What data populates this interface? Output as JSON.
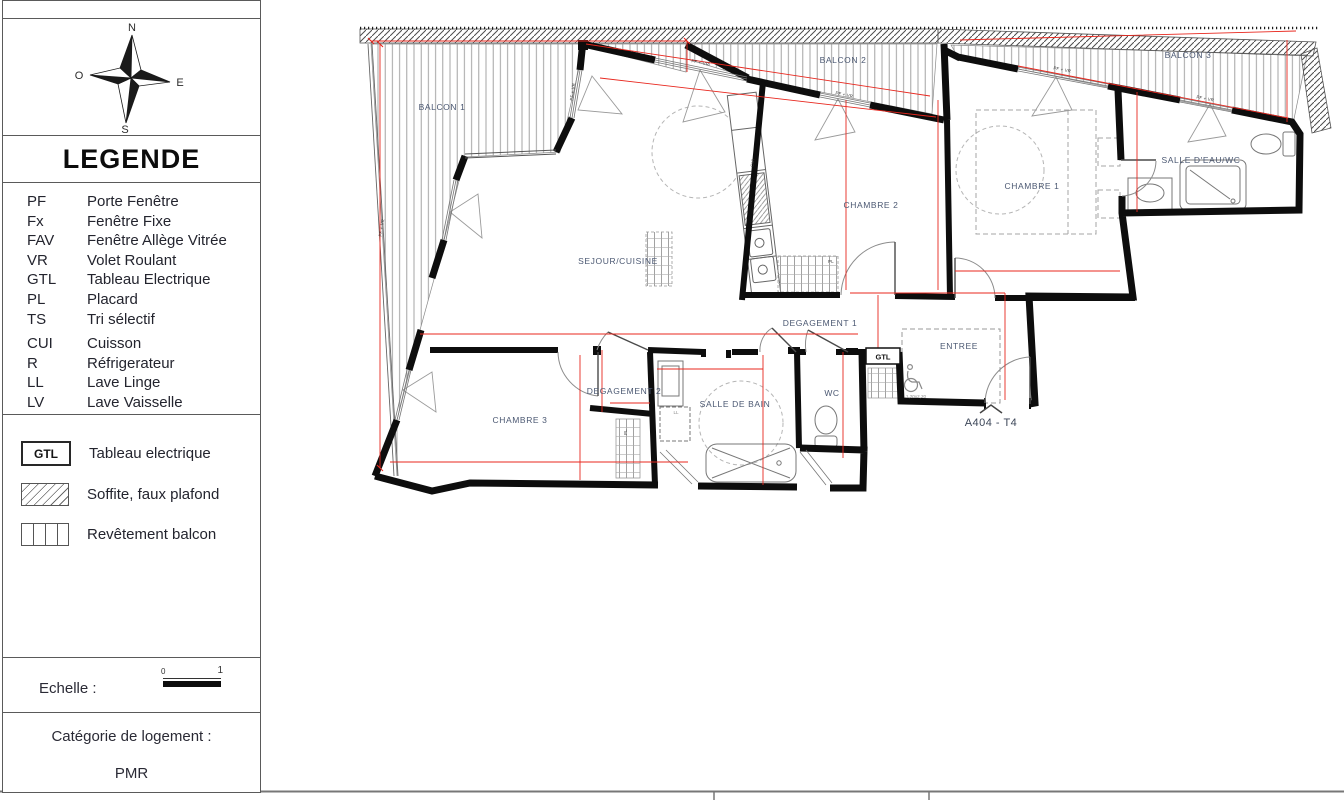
{
  "sidebar": {
    "compass": {
      "north": "N",
      "east": "E",
      "south": "S",
      "west": "O"
    },
    "legend_title": "LEGENDE",
    "abbreviations": [
      {
        "abbr": "PF",
        "label": "Porte Fenêtre"
      },
      {
        "abbr": "Fx",
        "label": "Fenêtre Fixe"
      },
      {
        "abbr": "FAV",
        "label": "Fenêtre Allège Vitrée"
      },
      {
        "abbr": "VR",
        "label": "Volet Roulant"
      },
      {
        "abbr": "GTL",
        "label": "Tableau Electrique"
      },
      {
        "abbr": "PL",
        "label": "Placard"
      },
      {
        "abbr": "TS",
        "label": "Tri sélectif"
      },
      {
        "abbr": "CUI",
        "label": "Cuisson"
      },
      {
        "abbr": "R",
        "label": "Réfrigerateur"
      },
      {
        "abbr": "LL",
        "label": "Lave Linge"
      },
      {
        "abbr": "LV",
        "label": "Lave Vaisselle"
      }
    ],
    "symbols": [
      {
        "swatch": "GTL",
        "label": "Tableau electrique"
      },
      {
        "swatch": "",
        "label": "Soffite, faux plafond"
      },
      {
        "swatch": "",
        "label": "Revêtement balcon"
      }
    ],
    "scale": {
      "label": "Echelle :",
      "start": "0",
      "end": "1"
    },
    "category": {
      "label": "Catégorie de logement :",
      "value": "PMR"
    }
  },
  "plan": {
    "unit_label": "A404 - T4",
    "rooms": {
      "balcon1": "BALCON 1",
      "balcon2": "BALCON 2",
      "balcon3": "BALCON 3",
      "sejour": "SEJOUR/CUISINE",
      "chambre1": "CHAMBRE 1",
      "chambre2": "CHAMBRE 2",
      "chambre3": "CHAMBRE 3",
      "salle_eau": "SALLE D'EAU/WC",
      "salle_bain": "SALLE DE BAIN",
      "degagement1": "DEGAGEMENT 1",
      "degagement2": "DEGAGEMENT 2",
      "entree": "ENTREE",
      "wc": "WC"
    },
    "tags": {
      "gtl": "GTL",
      "window": "PF + VR",
      "cuisson": "CUI",
      "lave_linge": "LL",
      "placard": "PL",
      "clearance": "1,20x2,20"
    }
  },
  "colors": {
    "wall": "#0d0d0d",
    "dimension": "#e8271e",
    "room_label": "#4b5872"
  }
}
